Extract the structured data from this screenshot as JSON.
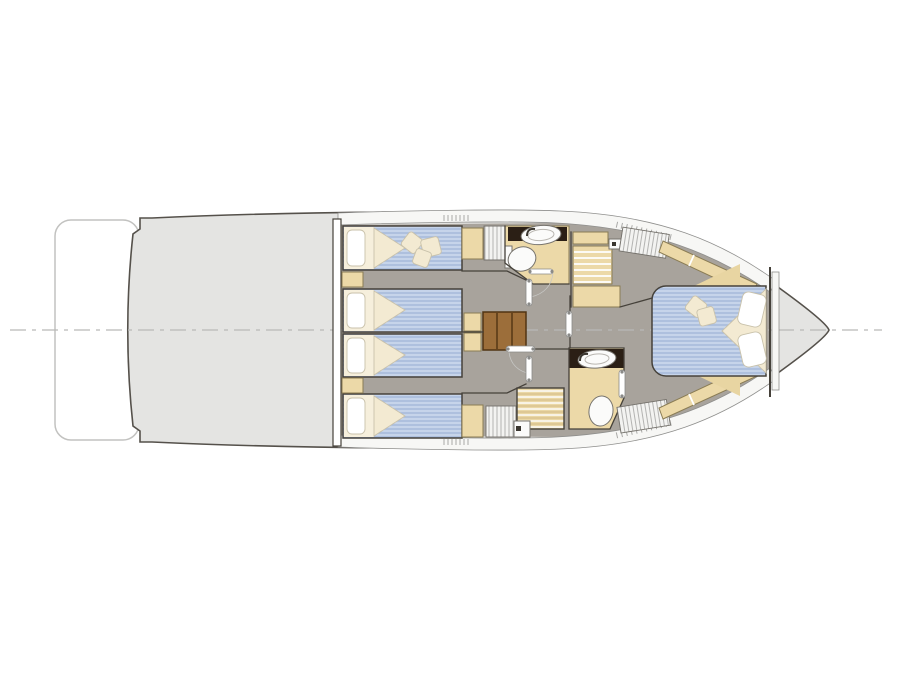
{
  "page": {
    "background": "#ffffff",
    "width": 900,
    "height": 675
  },
  "diagram": {
    "type": "floorplan",
    "subject": "Motor yacht lower deck layout plan",
    "orientation": "bow-right",
    "areas": [
      {
        "name": "swim-platform"
      },
      {
        "name": "aft-deck"
      },
      {
        "name": "aft-cabin-port",
        "furniture": [
          "single-bed",
          "single-bed",
          "nightstand",
          "side-cabinet",
          "wardrobe"
        ]
      },
      {
        "name": "aft-cabin-starboard",
        "furniture": [
          "single-bed",
          "single-bed",
          "nightstand",
          "side-cabinet",
          "wardrobe"
        ]
      },
      {
        "name": "companionway-stairs"
      },
      {
        "name": "bathroom-port",
        "furniture": [
          "vanity-counter",
          "washbasin",
          "toilet"
        ]
      },
      {
        "name": "bathroom-starboard",
        "furniture": [
          "vanity-counter",
          "washbasin",
          "toilet",
          "shower-grate"
        ]
      },
      {
        "name": "staircase-to-main-deck"
      },
      {
        "name": "master-cabin-bow",
        "furniture": [
          "double-bed",
          "wardrobe",
          "wardrobe",
          "hull-side-shelves"
        ]
      },
      {
        "name": "forepeak"
      }
    ],
    "counts": {
      "single_beds": 4,
      "double_beds": 1,
      "toilets": 2,
      "washbasins": 2,
      "showers": 1,
      "stair_flights": 2
    }
  },
  "colors": {
    "white": "#ffffff",
    "hull": "#e4e4e2",
    "hullLine": "#55514b",
    "platformLine": "#c2c2c0",
    "deckStrip": "#f7f7f5",
    "stripLine": "#8f8f8d",
    "floor": "#a8a39c",
    "wall": "#45413a",
    "cabinet": "#ecd9a8",
    "cabinetLine": "#8a7c54",
    "mattress": "#b7c7e3",
    "mattressStripe": "#a4b8da",
    "mattressLight": "#d6e0f1",
    "bedding": "#f6efdc",
    "beddingLine": "#c9c2ab",
    "duvet": "#f3ead2",
    "counter": "#2b1f15",
    "wood": "#9c6e3a",
    "woodLine": "#513413",
    "fixture": "#fbfbfa",
    "fixtureLine": "#77746e",
    "hatchBg": "#f3f3f1",
    "hatchLine": "#b3b3b1",
    "teak": "#ead7a5",
    "teakLine": "#ffffff",
    "teakDark": "#d2ba82",
    "centerline": "#b9b9b7",
    "doorLine": "#8a8a88"
  }
}
